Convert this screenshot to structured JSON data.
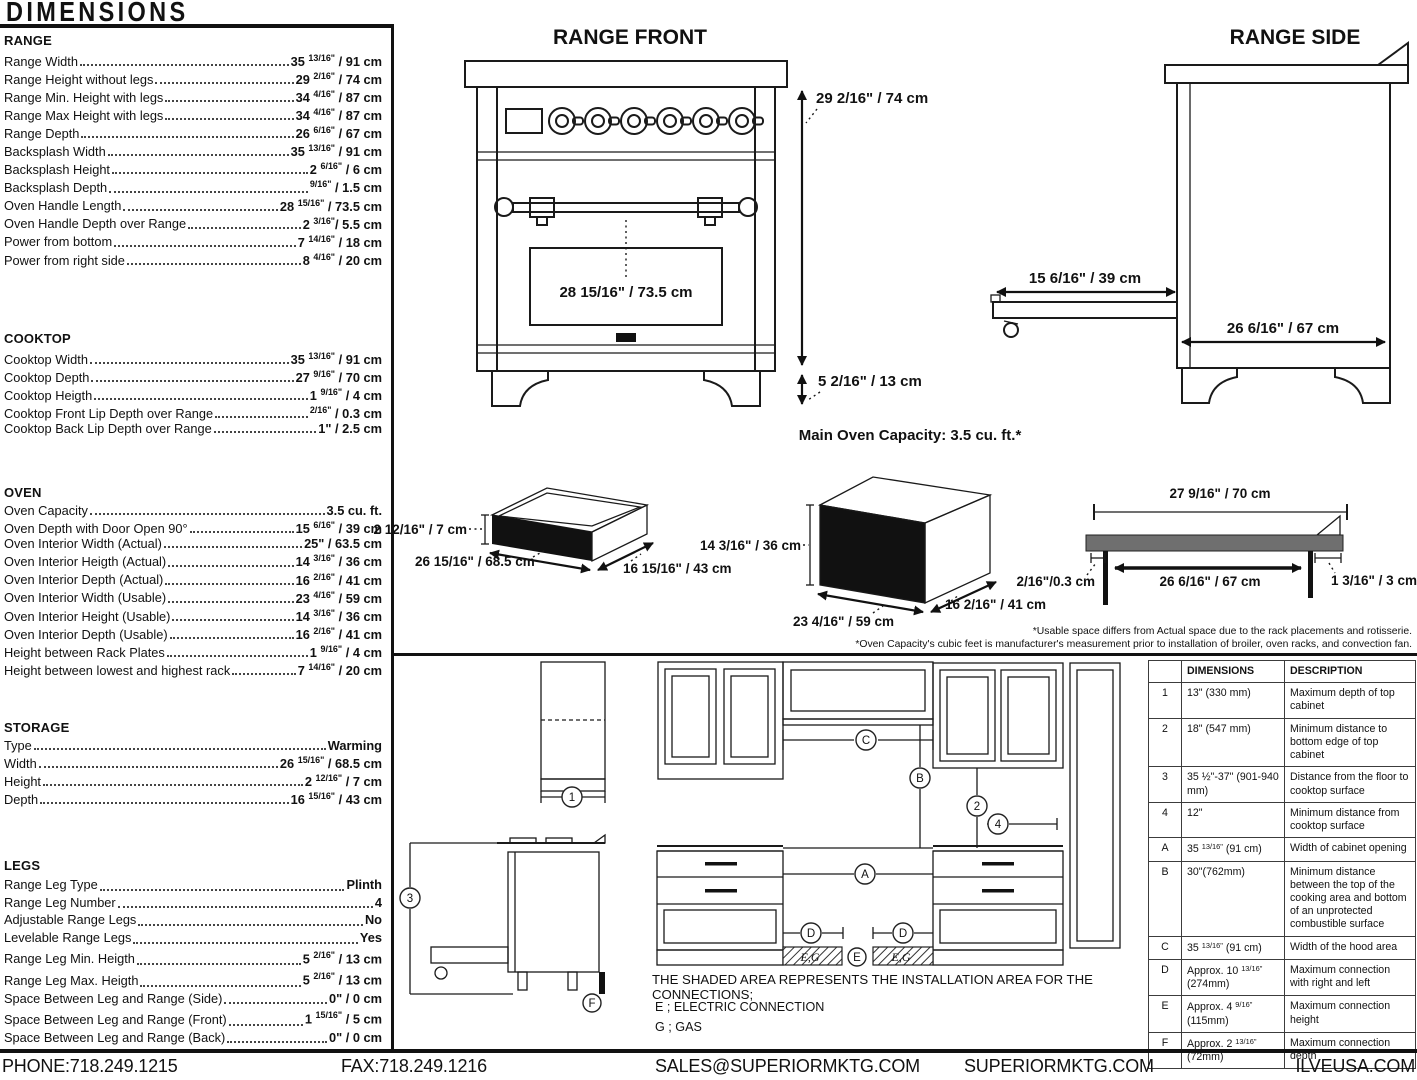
{
  "title": "DIMENSIONS",
  "specs": [
    {
      "heading": "RANGE",
      "items": [
        {
          "label": "Range Width",
          "value": "35 13/16\" / 91 cm"
        },
        {
          "label": "Range Height without legs",
          "value": "29 2/16\" / 74 cm"
        },
        {
          "label": "Range Min. Height with legs",
          "value": "34 4/16\" / 87 cm"
        },
        {
          "label": "Range Max Height with legs",
          "value": "34 4/16\" / 87 cm"
        },
        {
          "label": "Range Depth",
          "value": "26 6/16\" / 67 cm"
        },
        {
          "label": "Backsplash Width",
          "value": "35 13/16\" / 91 cm"
        },
        {
          "label": "Backsplash Height",
          "value": "2 6/16\" / 6 cm"
        },
        {
          "label": "Backsplash Depth",
          "value": "9/16\" / 1.5 cm"
        },
        {
          "label": "Oven Handle Length",
          "value": "28 15/16\" / 73.5 cm"
        },
        {
          "label": "Oven Handle Depth over Range",
          "value": "2 3/16\"/ 5.5 cm"
        },
        {
          "label": "Power from bottom",
          "value": "7 14/16\" / 18 cm"
        },
        {
          "label": "Power from right side",
          "value": "8 4/16\" / 20 cm"
        }
      ]
    },
    {
      "heading": "COOKTOP",
      "items": [
        {
          "label": "Cooktop Width",
          "value": "35 13/16\" / 91 cm"
        },
        {
          "label": "Cooktop Depth",
          "value": "27 9/16\" / 70 cm"
        },
        {
          "label": "Cooktop Heigth",
          "value": "1 9/16\" / 4 cm"
        },
        {
          "label": "Cooktop Front Lip Depth over Range",
          "value": "2/16\" / 0.3 cm"
        },
        {
          "label": "Cooktop Back Lip Depth over Range",
          "value": "1\" / 2.5 cm"
        }
      ]
    },
    {
      "heading": "OVEN",
      "items": [
        {
          "label": "Oven Capacity",
          "value": "3.5 cu. ft."
        },
        {
          "label": "Oven Depth with Door Open 90°",
          "value": "15 6/16\" / 39 cm"
        },
        {
          "label": "Oven Interior Width (Actual)",
          "value": "25\" / 63.5 cm"
        },
        {
          "label": "Oven Interior Heigth (Actual)",
          "value": "14 3/16\" / 36 cm"
        },
        {
          "label": "Oven Interior Depth (Actual)",
          "value": "16 2/16\" / 41 cm"
        },
        {
          "label": "Oven Interior Width (Usable)",
          "value": "23 4/16\" / 59 cm"
        },
        {
          "label": "Oven Interior Height (Usable)",
          "value": "14 3/16\" / 36 cm"
        },
        {
          "label": "Oven Interior Depth (Usable)",
          "value": "16 2/16\" / 41 cm"
        },
        {
          "label": "Height between Rack Plates",
          "value": "1 9/16\" / 4 cm"
        },
        {
          "label": "Height between lowest and highest rack",
          "value": "7 14/16\" / 20 cm"
        }
      ]
    },
    {
      "heading": "STORAGE",
      "items": [
        {
          "label": "Type",
          "value": "Warming"
        },
        {
          "label": "Width",
          "value": "26 15/16\" / 68.5 cm"
        },
        {
          "label": "Height",
          "value": "2 12/16\" / 7 cm"
        },
        {
          "label": "Depth",
          "value": "16 15/16\" / 43 cm"
        }
      ]
    },
    {
      "heading": "LEGS",
      "items": [
        {
          "label": "Range Leg Type",
          "value": "Plinth"
        },
        {
          "label": "Range Leg Number",
          "value": "4"
        },
        {
          "label": "Adjustable Range Legs",
          "value": "No"
        },
        {
          "label": "Levelable Range Legs",
          "value": "Yes"
        },
        {
          "label": "Range Leg Min. Heigth",
          "value": "5 2/16\" / 13 cm"
        },
        {
          "label": "Range Leg Max. Heigth",
          "value": "5 2/16\" / 13 cm"
        },
        {
          "label": "Space Between Leg and Range (Side)",
          "value": "0\" / 0 cm"
        },
        {
          "label": "Space Between Leg and Range (Front)",
          "value": "1 15/16\" / 5 cm"
        },
        {
          "label": "Space Between Leg and Range (Back)",
          "value": "0\" / 0 cm"
        }
      ]
    }
  ],
  "front_view": {
    "title": "RANGE FRONT",
    "height_label": "29 2/16\" / 74 cm",
    "window_label": "28 15/16\" / 73.5 cm",
    "leg_label": "5 2/16\" / 13 cm"
  },
  "side_view": {
    "title": "RANGE SIDE",
    "door_label": "15 6/16\" / 39 cm",
    "depth_label": "26 6/16\" / 67 cm"
  },
  "capacity": {
    "title": "Main Oven Capacity: 3.5 cu. ft.*",
    "drawer": {
      "height": "2 12/16\" / 7 cm",
      "width": "26 15/16\" / 68.5 cm",
      "depth": "16 15/16\" / 43 cm"
    },
    "oven_box": {
      "height": "14 3/16\" / 36 cm",
      "width": "23 4/16\" / 59 cm",
      "depth": "16 2/16\" / 41 cm"
    },
    "rack": {
      "top": "27 9/16\" / 70 cm",
      "inner": "26 6/16\" / 67 cm",
      "left": "2/16\"/0.3 cm",
      "right": "1 3/16\" / 3 cm"
    },
    "footnote1": "*Usable space differs from Actual space due to the rack placements and rotisserie.",
    "footnote2": "*Oven Capacity's cubic feet is manufacturer's measurement prior to installation of broiler, oven racks, and convection fan."
  },
  "installation": {
    "note": "THE SHADED AREA REPRESENTS THE INSTALLATION AREA FOR THE CONNECTIONS;",
    "legend_e": "E ; ELECTRIC CONNECTION",
    "legend_g": "G ; GAS",
    "shaded_label": "E,G",
    "callouts": {
      "n1": "1",
      "n2": "2",
      "n3": "3",
      "n4": "4",
      "A": "A",
      "B": "B",
      "C": "C",
      "D": "D",
      "E": "E",
      "F": "F"
    },
    "table": {
      "headers": [
        "",
        "DIMENSIONS",
        "DESCRIPTION"
      ],
      "rows": [
        [
          "1",
          "13\" (330 mm)",
          "Maximum depth of top cabinet"
        ],
        [
          "2",
          "18\" (547 mm)",
          "Minimum distance to bottom edge of top cabinet"
        ],
        [
          "3",
          "35 ½\"-37\" (901-940 mm)",
          "Distance from the floor to cooktop surface"
        ],
        [
          "4",
          "12\"",
          "Minimum distance from cooktop surface"
        ],
        [
          "A",
          "35 13/16\" (91 cm)",
          "Width of cabinet opening"
        ],
        [
          "B",
          "30\"(762mm)",
          "Minimum distance between the top of the cooking area and bottom of an unprotected combustible surface"
        ],
        [
          "C",
          "35 13/16\" (91 cm)",
          "Width of the hood area"
        ],
        [
          "D",
          "Approx. 10 13/16\" (274mm)",
          "Maximum connection with right and left"
        ],
        [
          "E",
          "Approx. 4 9/16\" (115mm)",
          "Maximum connection height"
        ],
        [
          "F",
          "Approx. 2 13/16\" (72mm)",
          "Maximum connection depth"
        ]
      ]
    }
  },
  "footer": {
    "phone": "PHONE:718.249.1215",
    "fax": "FAX:718.249.1216",
    "email": "SALES@SUPERIORMKTG.COM",
    "site": "SUPERIORMKTG.COM",
    "brand": "ILVEUSA.COM"
  }
}
